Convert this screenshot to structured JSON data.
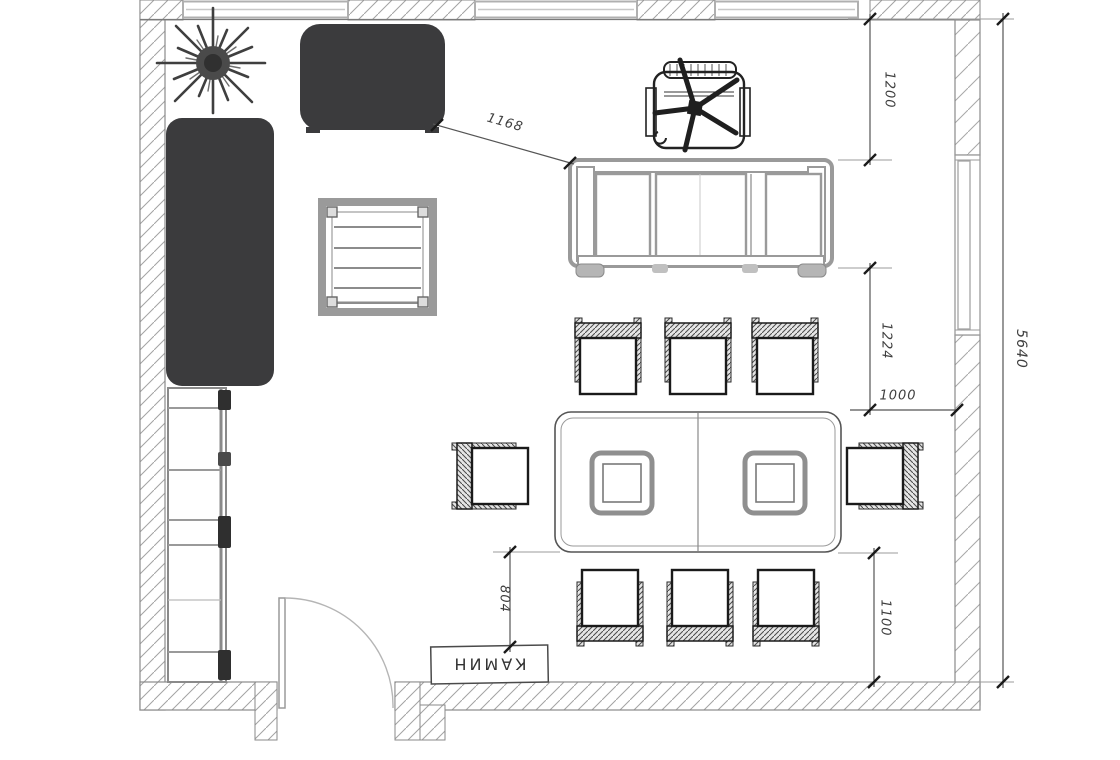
{
  "plan": {
    "type": "floor-plan",
    "fireplace_label": "КАМИН",
    "dims": {
      "d1200": "1200",
      "d1224": "1224",
      "d1000": "1000",
      "d1100": "1100",
      "d5640": "5640",
      "d804": "804",
      "d1168": "1168"
    },
    "colors": {
      "dark_furniture": "#3b3b3d",
      "gray_furniture": "#9a9a9a",
      "wall_line": "#7a7a7a",
      "dim_line": "#555555",
      "dim_text": "#3f3f3f",
      "background": "#ffffff"
    }
  }
}
